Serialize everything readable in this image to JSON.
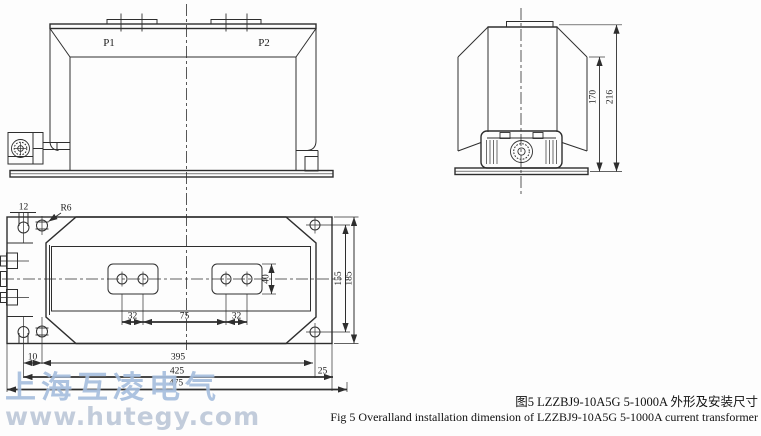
{
  "figure": {
    "caption_zh": "图5 LZZBJ9-10A5G  5-1000A 外形及安装尺寸",
    "caption_en": "Fig 5 Overalland installation dimension of LZZBJ9-10A5G 5-1000A  current transformer"
  },
  "watermark": {
    "company": "上海互凌电气",
    "website": "www.hutegy.com"
  },
  "front_view": {
    "terminal_p1": "P1",
    "terminal_p2": "P2"
  },
  "side_view": {
    "dim_body_height": "170",
    "dim_total_height": "216"
  },
  "plan_view": {
    "dim_slot_width": "12",
    "dim_slot_radius": "R6",
    "dim_hole_pitch_left": "32",
    "dim_hole_pitch_center": "75",
    "dim_hole_pitch_right": "32",
    "dim_pad_height": "40",
    "dim_mount_pitch_v": "155",
    "dim_plate_depth": "185",
    "dim_edge_offset": "10",
    "dim_mount_pitch_h": "395",
    "dim_width_inner": "425",
    "dim_edge_right": "25",
    "dim_total_width": "475"
  },
  "colors": {
    "line": "#2e2e2e",
    "background": "#fdfdfd",
    "watermark_blue": "#7a9ecd"
  }
}
